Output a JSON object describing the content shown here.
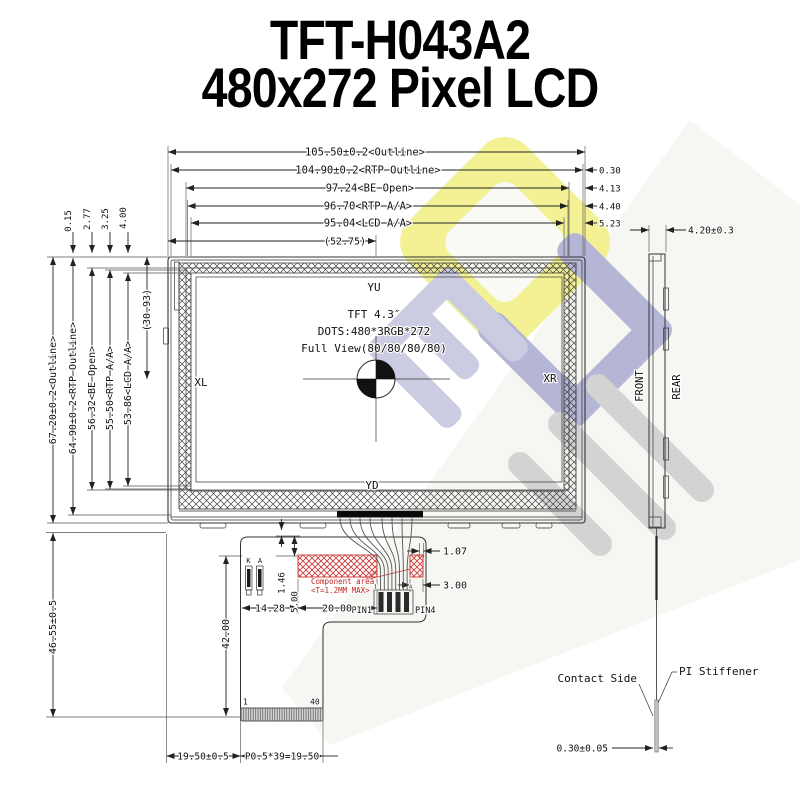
{
  "title": {
    "line1": "TFT-H043A2",
    "line2": "480x272 Pixel LCD"
  },
  "front_view": {
    "horizontal_dims": {
      "outline": "105.50±0.2<Outline>",
      "rtp_outline": "104.90±0.2<RTP Outline>",
      "be_open": "97.24<BE Open>",
      "rtp_aa": "96.70<RTP A/A>",
      "lcd_aa": "95.04<LCD A/A>",
      "center": "(52.75)"
    },
    "right_offsets": {
      "rtp": "0.30",
      "be": "4.13",
      "rtp_aa": "4.40",
      "lcd_aa": "5.23"
    },
    "vertical_dims": {
      "outline": "67.20±0.2<Outline>",
      "rtp_outline": "64.90±0.2<RTP Outline>",
      "be_open": "56.32<BE Open>",
      "rtp_aa": "55.50<RTP A/A>",
      "lcd_aa": "53.86<LCD A/A>",
      "center": "(30.93)"
    },
    "top_offsets": {
      "rtp": "0.15",
      "be": "2.77",
      "rtp_aa": "3.25",
      "lcd_aa": "4.00"
    },
    "display": {
      "label_top": "YU",
      "label_bottom": "YD",
      "label_left": "XL",
      "label_right": "XR",
      "line1": "TFT 4.3″",
      "line2": "DOTS:480*3RGB*272",
      "line3": "Full View(80/80/80/80)"
    }
  },
  "side_view": {
    "thickness": "4.20±0.3",
    "front": "FRONT",
    "rear": "REAR"
  },
  "fpc": {
    "pin_k": "K",
    "pin_a": "A",
    "dim_gap": "1.46",
    "dim_clearance": "5.00",
    "dim_left": "14.28",
    "dim_width": "20.00",
    "dim_pin_offset": "1.07",
    "dim_pin_width": "3.00",
    "dim_length": "42.00",
    "dim_total_length": "46.55±0.5",
    "component_area_line1": "Component area",
    "component_area_line2": "<T=1.2MM MAX>",
    "pin1": "PIN1",
    "pin4": "PIN4",
    "pin1_small": "1",
    "pin4_small": "4",
    "pad_first": "1",
    "pad_last": "40",
    "dim_tail_offset": "19.50±0.5",
    "dim_pitch": "P0.5*39=19.50"
  },
  "tail_detail": {
    "contact_side": "Contact Side",
    "pi_stiffener": "PI Stiffener",
    "thickness": "0.30±0.05"
  },
  "colors": {
    "line": "#222222",
    "component_red": "#cc3333",
    "watermark_yellow": "#f1ee7a",
    "watermark_purple": "#a3a3cd",
    "watermark_gray": "#c9c9c9"
  }
}
